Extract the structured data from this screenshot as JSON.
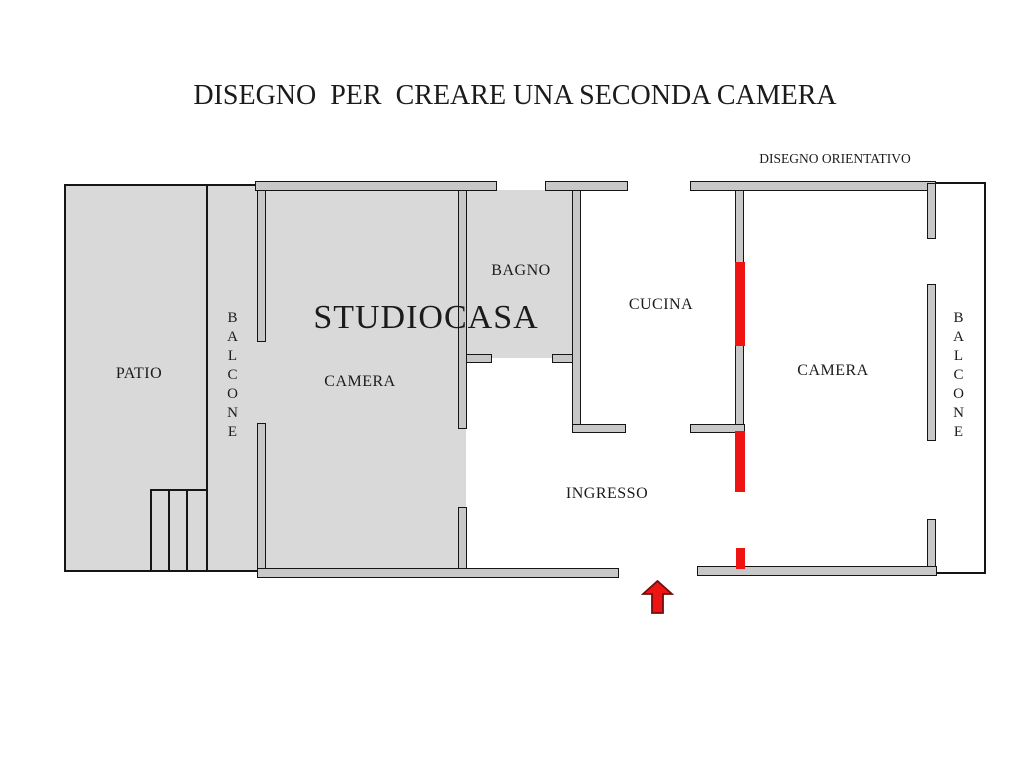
{
  "title": "DISEGNO  PER  CREARE UNA SECONDA CAMERA",
  "subtitle": "DISEGNO ORIENTATIVO",
  "watermark": "STUDIOCASA",
  "rooms": {
    "patio": "PATIO",
    "balcone_left": "BALCONE",
    "camera_left": "CAMERA",
    "bagno": "BAGNO",
    "cucina": "CUCINA",
    "ingresso": "INGRESSO",
    "camera_right": "CAMERA",
    "balcone_right": "BALCONE"
  },
  "colors": {
    "background": "#ffffff",
    "room_fill": "#d9d9d9",
    "wall_fill": "#c8c8c8",
    "outline": "#151515",
    "highlight_red": "#ee1414",
    "text": "#1b1b1b"
  },
  "icons": {
    "entrance_arrow": "red-up-block-arrow"
  }
}
